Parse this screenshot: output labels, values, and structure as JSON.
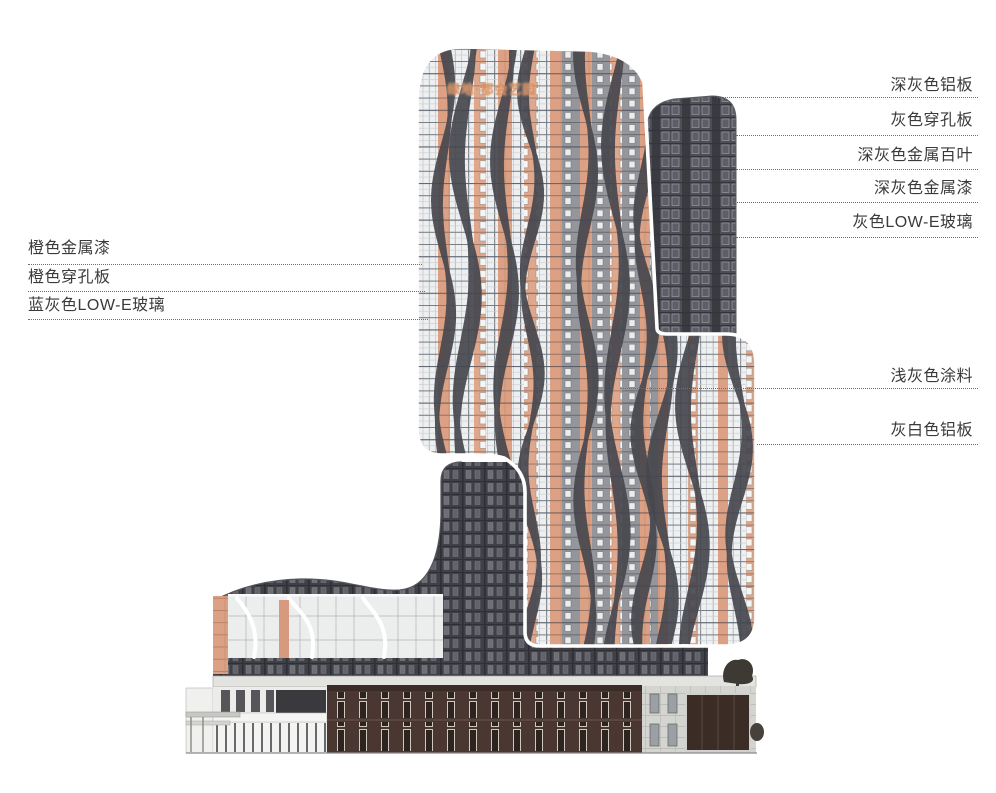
{
  "figure": {
    "type": "building-elevation-material-callouts",
    "watermark": {
      "text": "绿地·都会艺园"
    }
  },
  "annotations": {
    "left": [
      {
        "label": "橙色金属漆"
      },
      {
        "label": "橙色穿孔板"
      },
      {
        "label": "蓝灰色LOW-E玻璃"
      }
    ],
    "right": [
      {
        "label": "深灰色铝板"
      },
      {
        "label": "灰色穿孔板"
      },
      {
        "label": "深灰色金属百叶"
      },
      {
        "label": "深灰色金属漆"
      },
      {
        "label": "灰色LOW-E玻璃"
      },
      {
        "label": "浅灰色涂料"
      },
      {
        "label": "灰白色铝板"
      }
    ]
  },
  "colors": {
    "orange_panel": "#dfa78b",
    "dark_gray_panel": "#4a4a52",
    "light_gray_paint": "#eef0f1",
    "gray_low_e_glass": "#94969b",
    "brown_podium": "#4a3731",
    "stone_panel": "#d4d4d1",
    "label_text": "#3a3a3a",
    "leader_line": "#6d6d6d",
    "watermark_orange": "#d27d46"
  }
}
